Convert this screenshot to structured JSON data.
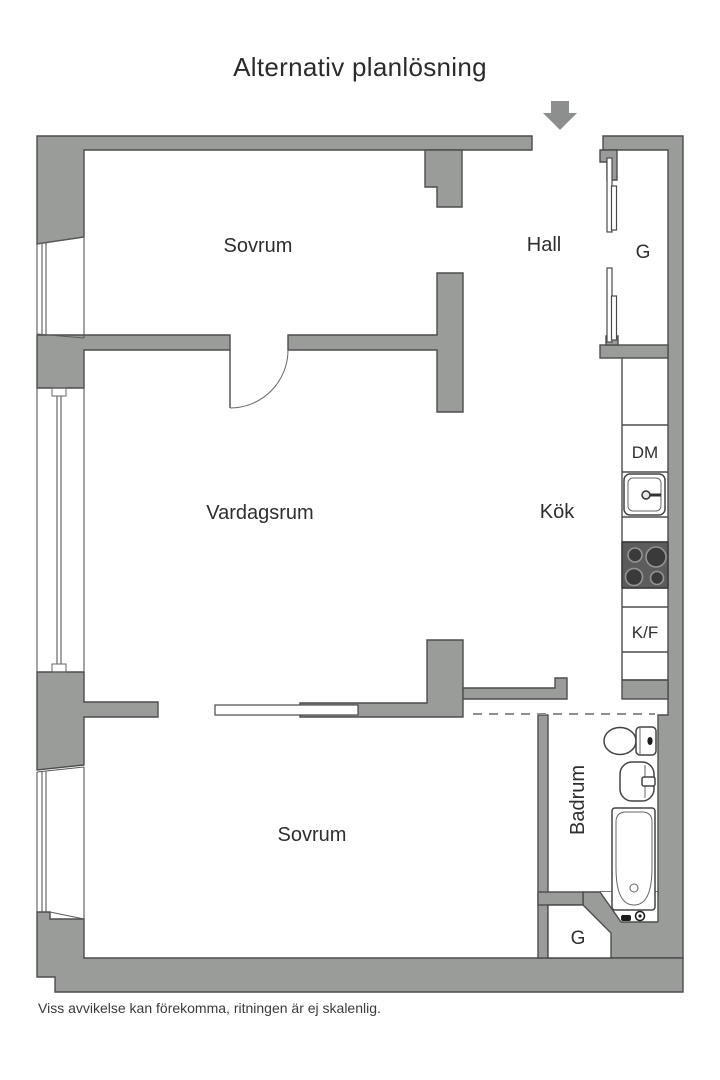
{
  "title": "Alternativ planlösning",
  "footer": "Viss avvikelse kan förekomma, ritningen är ej skalenlig.",
  "rooms": {
    "bedroom_top": "Sovrum",
    "hall": "Hall",
    "closet_top": "G",
    "living_room": "Vardagsrum",
    "kitchen": "Kök",
    "bathroom": "Badrum",
    "bedroom_bottom": "Sovrum",
    "closet_bottom": "G"
  },
  "appliances": {
    "dishwasher": "DM",
    "fridge_freezer": "K/F"
  },
  "icons": {
    "entrance_arrow": "down-arrow marks apartment entrance",
    "stove": "4-burner cooktop",
    "kitchen_sink": "kitchen sink with faucet",
    "toilet": "toilet",
    "washbasin": "washbasin",
    "bathtub": "bathtub"
  },
  "colors": {
    "wall": "#9a9c9a",
    "outline": "#4d4d4d",
    "stove": "#5c5c5c",
    "arrow": "#8d8f8e",
    "text": "#2e2e2e"
  }
}
